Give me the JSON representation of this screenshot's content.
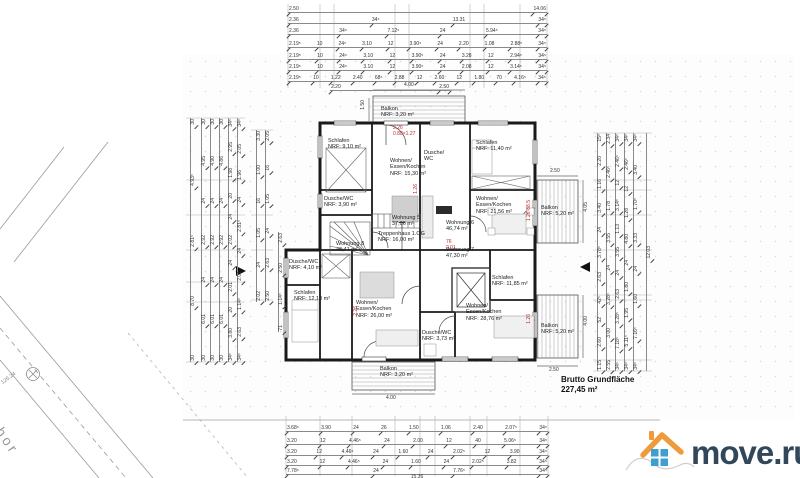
{
  "summary": {
    "label": "Brutto Grundfläche",
    "value": "227,45 m²"
  },
  "logo": {
    "text": "move.ru",
    "roof_color": "#ef9b3c",
    "window_color": "#3f9fcf",
    "text_color": "#33475a"
  },
  "site_plan": {
    "street_text": "shor",
    "marker_text": "126.24"
  },
  "rooms": [
    "Balkon\nNRF: 3,20 m²",
    "Schlafen\nNRF: 9,10 m²",
    "Wohnen/\nEssen/Kochen\nNRF: 15,30 m²",
    "Schlafen\nNRF: 11,40 m²",
    "Dusche/\nWC",
    "Wohnen/\nEssen/Kochen\nNRF: 21,56 m²",
    "Balkon\nNRF: 5,20 m²",
    "Dusche/WC\nNRF: 3,90 m²",
    "Wohnung 5\n37,06 m²",
    "Treppenhaus 1.OG\nNRF: 16,00 m²",
    "Wohnung 6\n46,74 m²",
    "Wohnung 7\n47,30 m²",
    "Wohnung 8\n46,41 m²",
    "Dusche/WC\nNRF: 4,10 m²",
    "Schlafen\nNRF: 12,10 m²",
    "Wohnen/\nEssen/Kochen\nNRF: 26,00 m²",
    "Schlafen\nNRF: 11,85 m²",
    "Wohnen/\nEssen/Kochen\nNRF: 28,76 m²",
    "Dusche/WC\nNRF: 3,73 m²",
    "Balkon\nNRF: 5,20 m²",
    "Balkon\nNRF: 3,20 m²"
  ],
  "annotations": [
    "2.26\n0.88×1.27",
    "1.26·88.5",
    "76\n2.01",
    "1.26",
    "2.26",
    "1.26"
  ],
  "minidims": [
    "4.00",
    "1.50",
    "2.50",
    "4.05",
    "4.00",
    "2.50",
    "4.00"
  ],
  "section_marker": "A",
  "dimensions": {
    "top": [
      [
        "2.50",
        "14.06"
      ],
      [
        "2.36",
        "34⁵",
        "13.31",
        "34⁵"
      ],
      [
        "2.36",
        "34⁵",
        "7.12⁵",
        "24",
        "5.94⁵",
        "34⁵"
      ],
      [
        "2.19⁵",
        "10",
        "24⁵",
        "3.10",
        "12",
        "3.90⁵",
        "24",
        "2.20",
        "1.08",
        "2.88⁵",
        "34⁵"
      ],
      [
        "2.19⁵",
        "10",
        "24⁵",
        "3.10",
        "12",
        "3.90⁵",
        "24",
        "3.28",
        "12",
        "2.94⁵",
        "34⁵"
      ],
      [
        "2.19⁵",
        "10",
        "24⁵",
        "3.10",
        "12",
        "3.90⁵",
        "24",
        "2.08",
        "12",
        "3.14⁵",
        "34⁵"
      ],
      [
        "2.19⁵",
        "10",
        "1.22",
        "2.40",
        "68⁵",
        "2.88",
        "12",
        "2.60",
        "12",
        "1.80",
        "70",
        "4.16⁵",
        "34⁵"
      ],
      [
        "2.20",
        "2.50"
      ]
    ],
    "bottom": [
      [
        "3.68⁵",
        "3.90",
        "24",
        "26",
        "1.50",
        "1.06",
        "2.40",
        "2.07⁵",
        "34⁵"
      ],
      [
        "3.20",
        "12",
        "4.46⁵",
        "24",
        "2.00",
        "12",
        "40",
        "5.06⁵",
        "34⁵"
      ],
      [
        "3.20",
        "12",
        "4.46⁵",
        "24",
        "1.60",
        "24",
        "2.02⁵",
        "12",
        "3.90",
        "34⁵"
      ],
      [
        "3.20",
        "12",
        "4.46⁵",
        "24",
        "1.60",
        "24",
        "2.02⁵",
        "3.82",
        "34⁵"
      ],
      [
        "7.78⁵",
        "24",
        "7.76⁵",
        "34⁵"
      ],
      [
        "15.36"
      ]
    ],
    "left": [
      [
        "30",
        "4.93⁵",
        "2.81⁵",
        "8.70",
        "30"
      ],
      [
        "30",
        "4.95",
        "24",
        "2.92",
        "24",
        "6.01",
        "30"
      ],
      [
        "30",
        "4.90",
        "24",
        "2.92",
        "24",
        "6.01",
        "30"
      ],
      [
        "30",
        "4.86",
        "24",
        "2.92",
        "24",
        "6.01",
        "30"
      ],
      [
        "34⁵",
        "2.95",
        "1.98",
        "20",
        "24",
        "2.02",
        "24",
        "2.01",
        "20",
        "3.80",
        "34⁵"
      ],
      [
        "34⁵",
        "2.05",
        "1.96",
        "24",
        "2.81⁵",
        "24",
        "2.01",
        "1.14⁵",
        "2.63",
        "34⁵"
      ],
      [
        "3.30",
        "1.00",
        "16",
        "1.05",
        "24",
        "2.02"
      ],
      [
        "2.05",
        "16",
        "1.05",
        "24",
        "2.63",
        "2.50"
      ],
      [
        "2.63",
        "2.50",
        "1.14⁵",
        "71"
      ]
    ],
    "right": [
      [
        "15⁵",
        "2.20",
        "1.16",
        "3.40",
        "24",
        "3.78⁵",
        "2.63",
        "42⁵",
        "52",
        "2.60",
        "1.15"
      ],
      [
        "2.34",
        "2.46⁵",
        "1.78",
        "3.55",
        "24",
        "3.28⁵",
        "3.00",
        "2.55"
      ],
      [
        "34⁵",
        "2.46⁵",
        "12",
        "3.14⁵",
        "1.13",
        "3.55",
        "24",
        "2.63",
        "3.28⁵",
        "7.18⁵",
        "34⁵"
      ],
      [
        "34⁵",
        "2.46⁵",
        "12",
        "1.28",
        "4.80",
        "24",
        "1.80",
        "1.95",
        "5.11⁵",
        "34⁵"
      ],
      [
        "34⁵",
        "3.40",
        "1.70⁵",
        "3.33",
        "24",
        "1.60",
        "7.16⁵",
        "34⁵"
      ],
      [
        "12.03"
      ]
    ]
  }
}
